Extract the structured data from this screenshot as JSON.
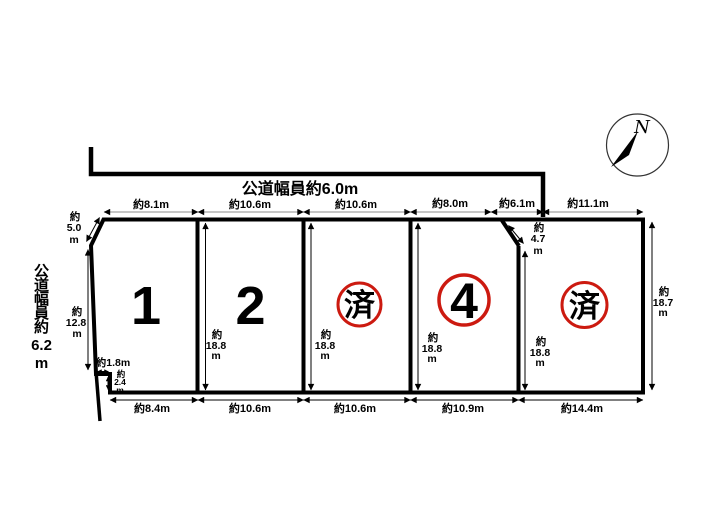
{
  "diagram": {
    "type": "land-plot-layout",
    "colors": {
      "stamp_red": "#cc1a10",
      "line_black": "#000000",
      "dim_gray": "#8c8c8c"
    },
    "roads": {
      "top_label": "公道幅員約6.0m",
      "left_label_chars": [
        "公",
        "道",
        "幅",
        "員",
        "約",
        "6.2",
        "m"
      ]
    },
    "compass": {
      "north_label": "N"
    },
    "plots": [
      {
        "label": "1",
        "display": "number"
      },
      {
        "label": "2",
        "display": "number"
      },
      {
        "label": "済",
        "display": "red-stamp",
        "status": "sold"
      },
      {
        "label": "4",
        "display": "red-circled-number"
      },
      {
        "label": "済",
        "display": "red-stamp",
        "status": "sold"
      }
    ],
    "dims_top": [
      "約8.1m",
      "約10.6m",
      "約10.6m",
      "約8.0m",
      "約6.1m",
      "約11.1m"
    ],
    "dims_bottom": [
      "約8.4m",
      "約10.6m",
      "約10.6m",
      "約10.9m",
      "約14.4m"
    ],
    "stacked": {
      "nw_corner": [
        "約",
        "5.0",
        "m"
      ],
      "left_depth": [
        "約",
        "12.8",
        "m"
      ],
      "step_width": "約1.8m",
      "step_height": [
        "約",
        "2.4",
        "m"
      ],
      "ne_corner": [
        "約",
        "4.7",
        "m"
      ],
      "plot2_depth": [
        "約",
        "18.8",
        "m"
      ],
      "plot3_depth": [
        "約",
        "18.8",
        "m"
      ],
      "plot4_depth": [
        "約",
        "18.8",
        "m"
      ],
      "plot5_depth": [
        "約",
        "18.8",
        "m"
      ],
      "right_depth": [
        "約",
        "18.7",
        "m"
      ]
    }
  }
}
